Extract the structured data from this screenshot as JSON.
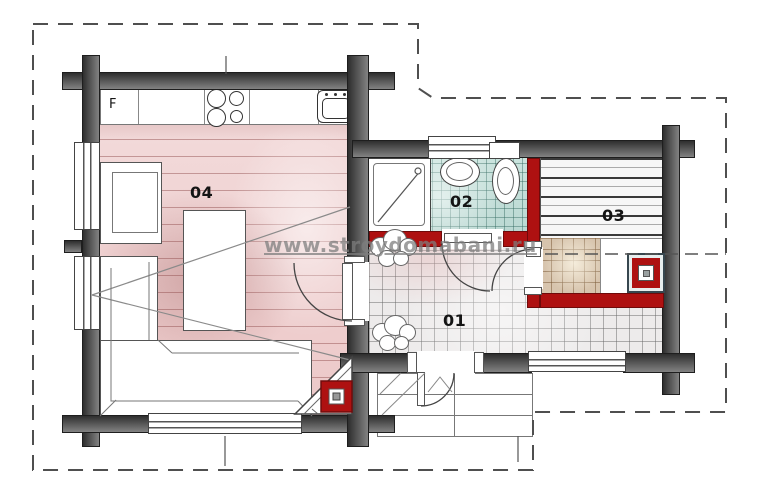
{
  "watermark": {
    "text": "www.stroydomabani.ru"
  },
  "rooms": {
    "hall": {
      "number": "01",
      "floor": "gray-tile"
    },
    "bath": {
      "number": "02",
      "floor": "teal-tile",
      "fixtures": [
        "shower",
        "washbasin",
        "toilet"
      ]
    },
    "sauna": {
      "number": "03",
      "fixtures": [
        "benches",
        "sauna-stove"
      ]
    },
    "living": {
      "number": "04",
      "fixtures": [
        "kitchen-counter",
        "hob",
        "sink",
        "fridge",
        "table",
        "sofa",
        "armchair",
        "corner-stove"
      ]
    }
  },
  "kitchen": {
    "fridge_label": "F"
  },
  "colors": {
    "wall_dark": "#3f3f3f",
    "wall_red": "#ae1111",
    "floor_pink": "#f0d2d2",
    "tile_teal": "#c4dfd9",
    "tile_gray": "#edebeb",
    "sauna_tan": "#d7c4ad"
  }
}
